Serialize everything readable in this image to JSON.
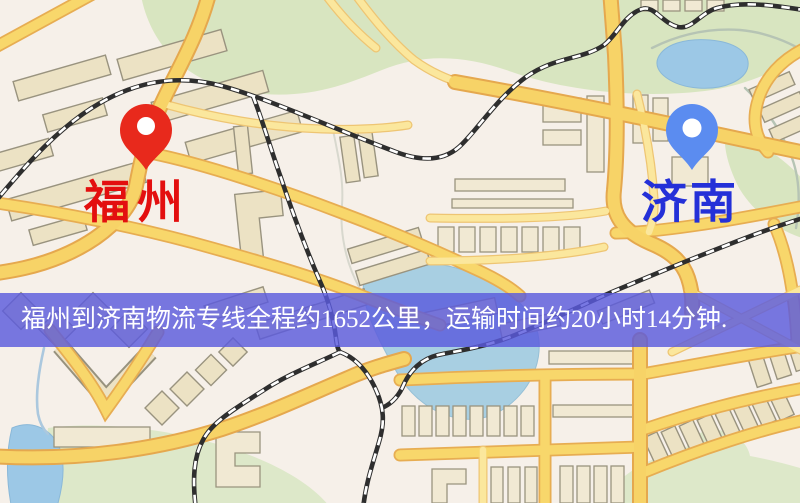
{
  "map": {
    "markers": {
      "origin": {
        "label": "福州",
        "pin_color": "#e8291c",
        "label_color": "#e30f0f"
      },
      "destination": {
        "label": "济南",
        "pin_color": "#5b8cf0",
        "label_color": "#2430d8"
      }
    },
    "palette": {
      "background": "#f6f0e9",
      "road_fill": "#f8d76b",
      "road_casing": "#e7ad52",
      "building": "#ece2c4",
      "park": "#d8e5c0",
      "water": "#9cc8e6",
      "railway": "#2e2e2e"
    }
  },
  "banner": {
    "text": "福州到济南物流专线全程约1652公里，运输时间约20小时14分钟.",
    "background": "#5a5add",
    "text_color": "#ffffff",
    "distance_km": 1652,
    "duration_text": "20小时14分钟"
  }
}
